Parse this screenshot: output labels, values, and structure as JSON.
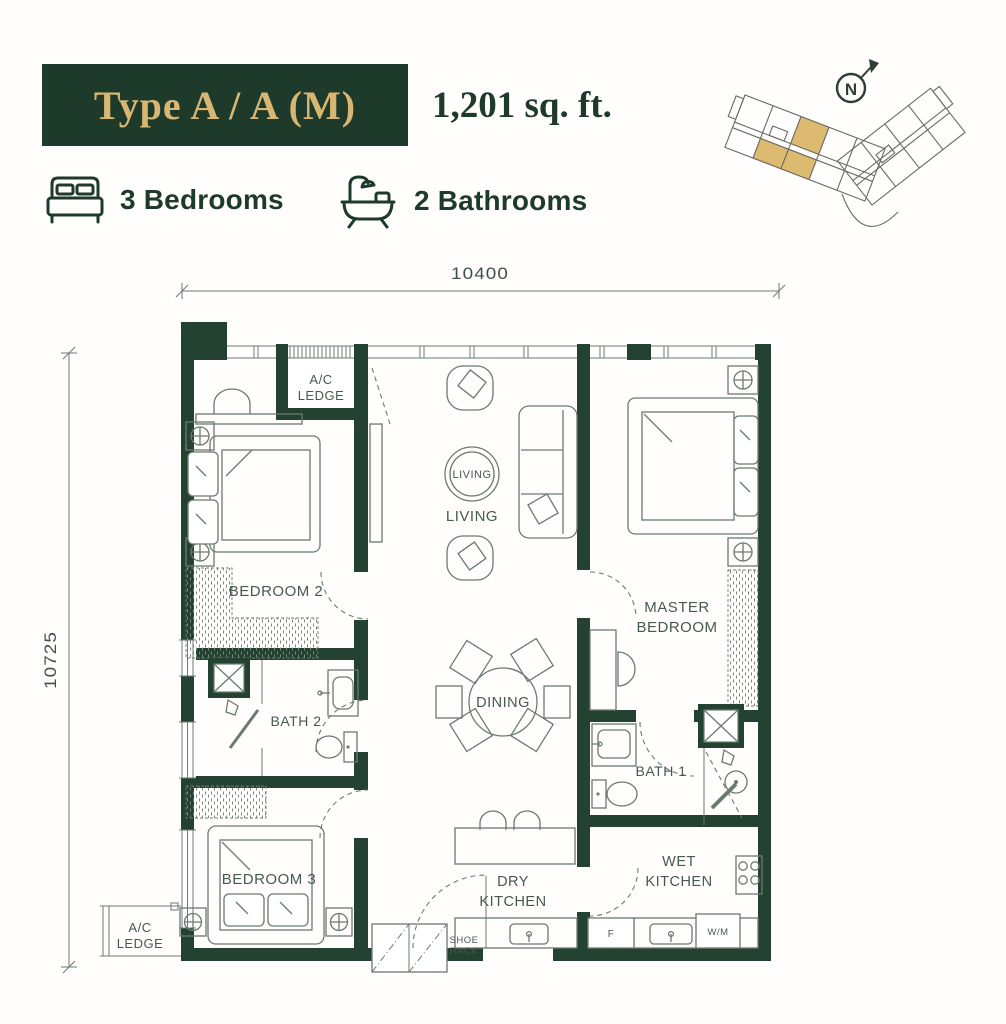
{
  "header": {
    "type_label": "Type A / A (M)",
    "area": "1,201 sq. ft.",
    "bedrooms": "3 Bedrooms",
    "bathrooms": "2 Bathrooms"
  },
  "key_plan": {
    "compass_label": "N"
  },
  "dimensions": {
    "top": "10400",
    "left": "10725"
  },
  "rooms": {
    "ac_ledge_top": {
      "line1": "A/C",
      "line2": "LEDGE"
    },
    "bedroom2": "BEDROOM 2",
    "living_circle": "LIVING",
    "living": "LIVING",
    "master": {
      "line1": "MASTER",
      "line2": "BEDROOM"
    },
    "bath2": "BATH 2",
    "dining": "DINING",
    "bath1": "BATH 1",
    "bedroom3": "BEDROOM 3",
    "dry_kitchen": {
      "line1": "DRY",
      "line2": "KITCHEN"
    },
    "wet_kitchen": {
      "line1": "WET",
      "line2": "KITCHEN"
    },
    "ac_ledge_bottom": {
      "line1": "A/C",
      "line2": "LEDGE"
    },
    "shoe_rack": {
      "line1": "SHOE",
      "line2": "RACK"
    },
    "washing_machine": "W/M",
    "fridge": "F"
  },
  "colors": {
    "dark": "#1d3a2a",
    "wall": "#234231",
    "gold": "#d9b671",
    "label": "#46594c",
    "line": "#6b7b6f",
    "key_gold": "#dcba70"
  }
}
